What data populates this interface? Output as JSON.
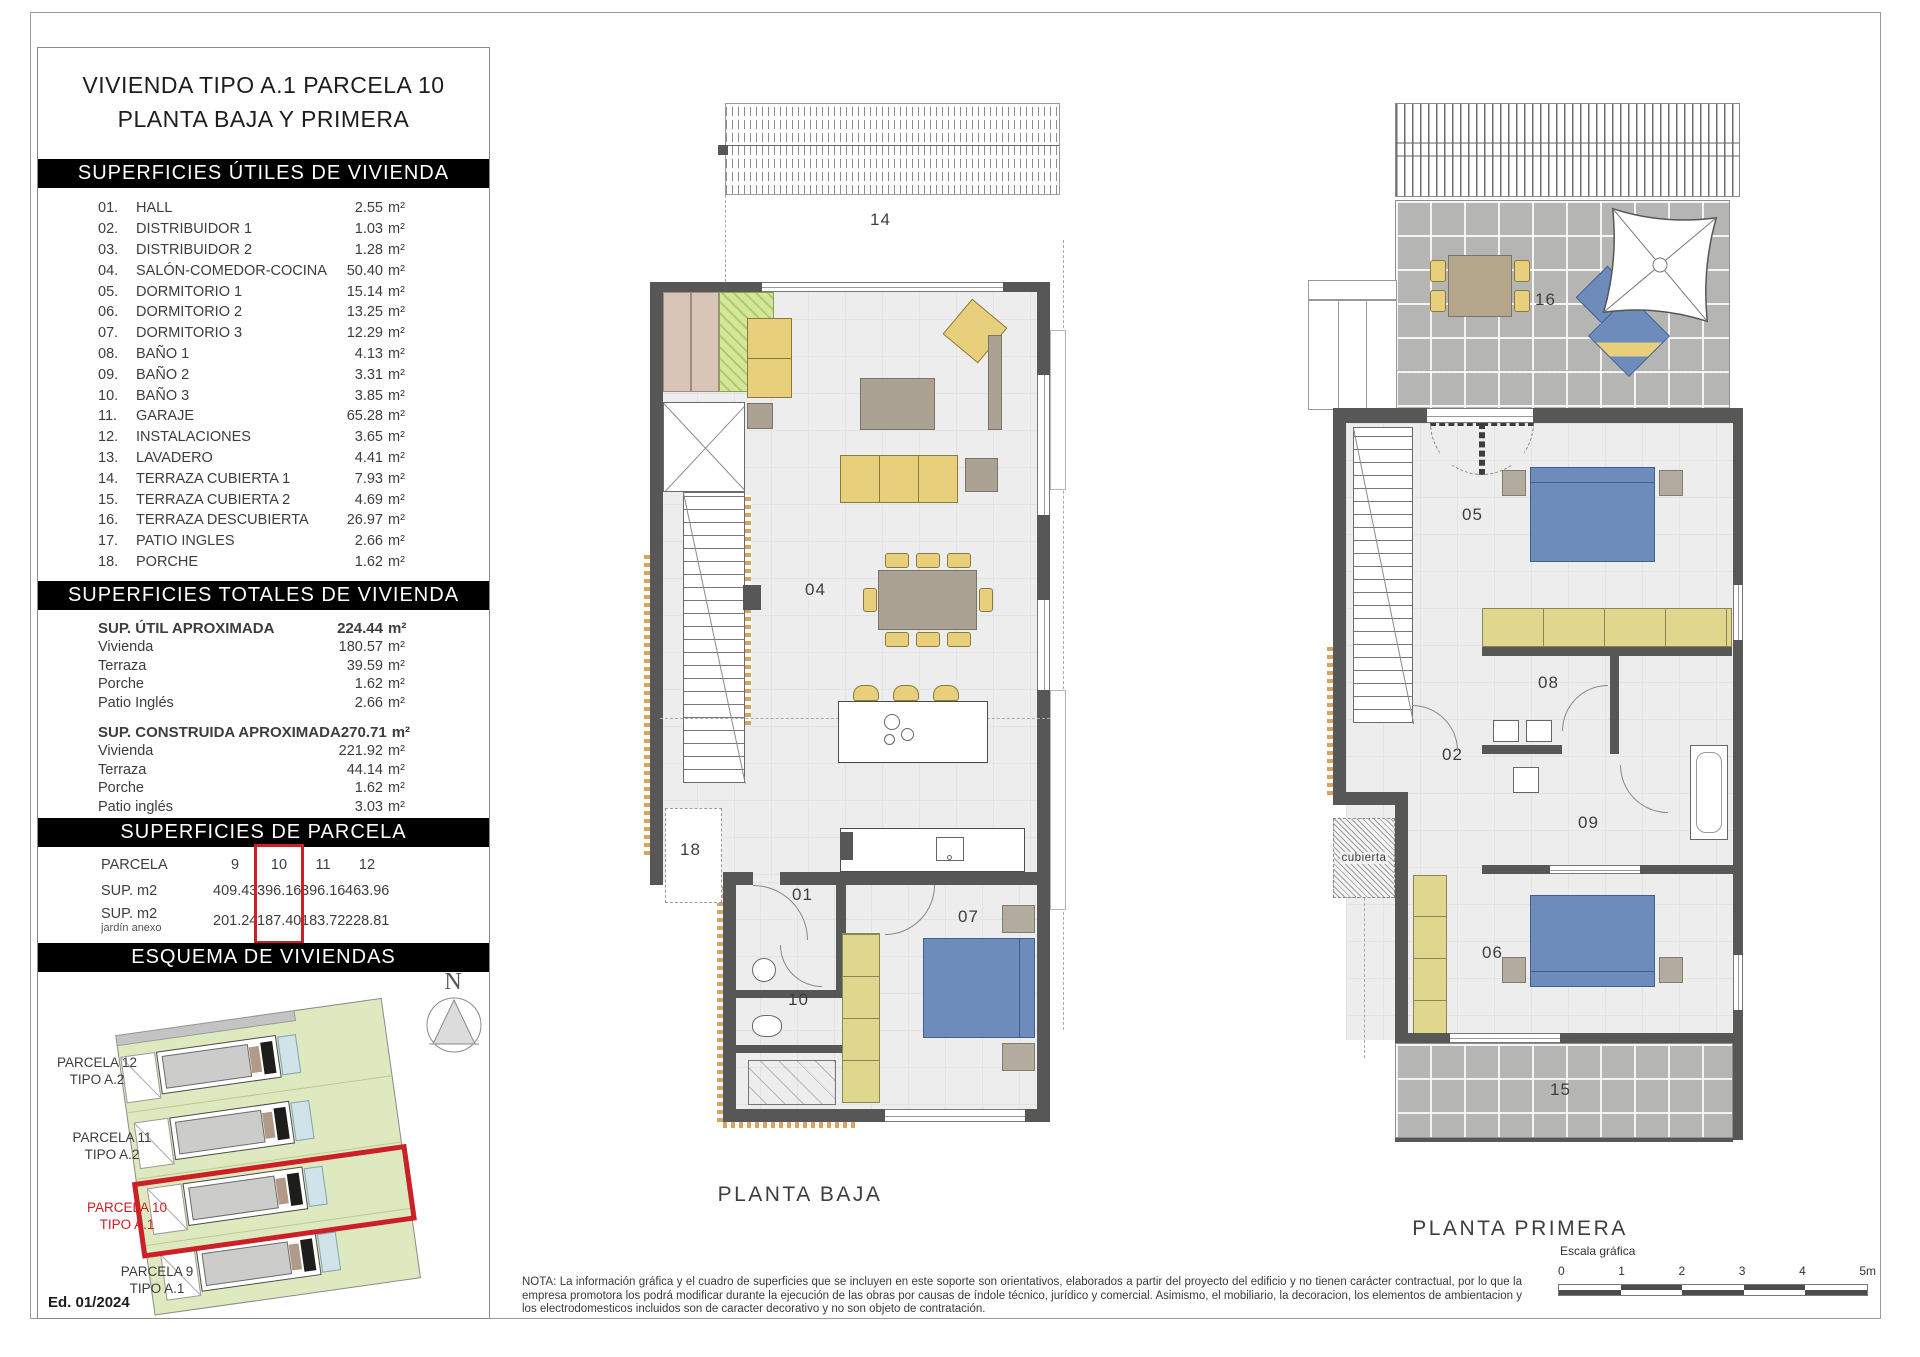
{
  "colors": {
    "black": "#000000",
    "red": "#cc2027",
    "wall": "#575756",
    "floor": "#ededed",
    "tile": "#b5b5b4",
    "furniture": "#e7cf7b",
    "wardrobe": "#e0d78f",
    "bed": "#6d8cbb",
    "table": "#aba293",
    "green": "#dfe9c0",
    "hatch_green": "#aecd66",
    "beige": "#d8c5b8",
    "pool": "#cfe3e8",
    "tan": "#d8a35e"
  },
  "sidebar": {
    "title_line1": "VIVIENDA TIPO A.1 PARCELA 10",
    "title_line2": "PLANTA BAJA Y PRIMERA",
    "sections": {
      "utiles_header": "SUPERFICIES ÚTILES DE VIVIENDA",
      "totales_header": "SUPERFICIES TOTALES DE VIVIENDA",
      "parcela_header": "SUPERFICIES DE PARCELA",
      "esquema_header": "ESQUEMA DE VIVIENDAS"
    },
    "rooms": [
      {
        "num": "01.",
        "label": "HALL",
        "value": "2.55",
        "unit": "m²"
      },
      {
        "num": "02.",
        "label": "DISTRIBUIDOR 1",
        "value": "1.03",
        "unit": "m²"
      },
      {
        "num": "03.",
        "label": "DISTRIBUIDOR 2",
        "value": "1.28",
        "unit": "m²"
      },
      {
        "num": "04.",
        "label": "SALÓN-COMEDOR-COCINA",
        "value": "50.40",
        "unit": "m²"
      },
      {
        "num": "05.",
        "label": "DORMITORIO 1",
        "value": "15.14",
        "unit": "m²"
      },
      {
        "num": "06.",
        "label": "DORMITORIO 2",
        "value": "13.25",
        "unit": "m²"
      },
      {
        "num": "07.",
        "label": "DORMITORIO 3",
        "value": "12.29",
        "unit": "m²"
      },
      {
        "num": "08.",
        "label": "BAÑO 1",
        "value": "4.13",
        "unit": "m²"
      },
      {
        "num": "09.",
        "label": "BAÑO 2",
        "value": "3.31",
        "unit": "m²"
      },
      {
        "num": "10.",
        "label": "BAÑO 3",
        "value": "3.85",
        "unit": "m²"
      },
      {
        "num": "11.",
        "label": "GARAJE",
        "value": "65.28",
        "unit": "m²"
      },
      {
        "num": "12.",
        "label": "INSTALACIONES",
        "value": "3.65",
        "unit": "m²"
      },
      {
        "num": "13.",
        "label": "LAVADERO",
        "value": "4.41",
        "unit": "m²"
      },
      {
        "num": "14.",
        "label": "TERRAZA CUBIERTA 1",
        "value": "7.93",
        "unit": "m²"
      },
      {
        "num": "15.",
        "label": "TERRAZA CUBIERTA 2",
        "value": "4.69",
        "unit": "m²"
      },
      {
        "num": "16.",
        "label": "TERRAZA DESCUBIERTA",
        "value": "26.97",
        "unit": "m²"
      },
      {
        "num": "17.",
        "label": "PATIO INGLES",
        "value": "2.66",
        "unit": "m²"
      },
      {
        "num": "18.",
        "label": "PORCHE",
        "value": "1.62",
        "unit": "m²"
      }
    ],
    "totals": {
      "util_label": "SUP. ÚTIL APROXIMADA",
      "util_value": "224.44",
      "util_unit": "m²",
      "util_rows": [
        {
          "label": "Vivienda",
          "value": "180.57",
          "unit": "m²"
        },
        {
          "label": "Terraza",
          "value": "39.59",
          "unit": "m²"
        },
        {
          "label": "Porche",
          "value": "1.62",
          "unit": "m²"
        },
        {
          "label": "Patio Inglés",
          "value": "2.66",
          "unit": "m²"
        }
      ],
      "construida_label": "SUP. CONSTRUIDA APROXIMADA",
      "construida_value": "270.71",
      "construida_unit": "m²",
      "construida_rows": [
        {
          "label": "Vivienda",
          "value": "221.92",
          "unit": "m²"
        },
        {
          "label": "Terraza",
          "value": "44.14",
          "unit": "m²"
        },
        {
          "label": "Porche",
          "value": "1.62",
          "unit": "m²"
        },
        {
          "label": "Patio inglés",
          "value": "3.03",
          "unit": "m²"
        }
      ]
    },
    "parcela_table": {
      "row_header": "PARCELA",
      "cols": [
        "9",
        "10",
        "11",
        "12"
      ],
      "sup_label": "SUP. m2",
      "sup_values": [
        "409.43",
        "396.16",
        "396.16",
        "463.96"
      ],
      "jardin_label": "SUP. m2",
      "jardin_sublabel": "jardín anexo",
      "jardin_values": [
        "201.24",
        "187.40",
        "183.72",
        "228.81"
      ],
      "highlighted_col": "10"
    },
    "esquema": {
      "north_label": "N",
      "parcels": [
        {
          "line1": "PARCELA 12",
          "line2": "TIPO A.2"
        },
        {
          "line1": "PARCELA 11",
          "line2": "TIPO A.2"
        },
        {
          "line1": "PARCELA 10",
          "line2": "TIPO A.1"
        },
        {
          "line1": "PARCELA 9",
          "line2": "TIPO A.1"
        }
      ],
      "edition": "Ed. 01/2024"
    }
  },
  "plans": {
    "baja": {
      "caption": "PLANTA BAJA",
      "rooms": {
        "terraza_cubierta1": "14",
        "salon_comedor_cocina": "04",
        "porche": "18",
        "hall": "01",
        "bano3": "10",
        "dormitorio3": "07"
      }
    },
    "primera": {
      "caption": "PLANTA PRIMERA",
      "rooms": {
        "terraza_descubierta": "16",
        "dormitorio1": "05",
        "bano1": "08",
        "distribuidor1": "02",
        "bano2": "09",
        "dormitorio2": "06",
        "terraza_cubierta2": "15"
      },
      "cubierta": "cubierta"
    }
  },
  "footer": {
    "note": "NOTA: La información gráfica y el cuadro de superficies que se incluyen en este soporte son orientativos, elaborados a partir del proyecto del edificio y no tienen carácter contractual, por lo que la empresa promotora los podrá modificar durante la ejecución de las obras por causas de índole técnico, jurídico y comercial. Asimismo, el mobiliario, la decoracion, los elementos de ambientacion y los electrodomesticos incluidos son de caracter decorativo y no son objeto de contratación.",
    "scale": {
      "label": "Escala gráfica",
      "ticks": [
        "0",
        "1",
        "2",
        "3",
        "4",
        "5m"
      ]
    }
  }
}
